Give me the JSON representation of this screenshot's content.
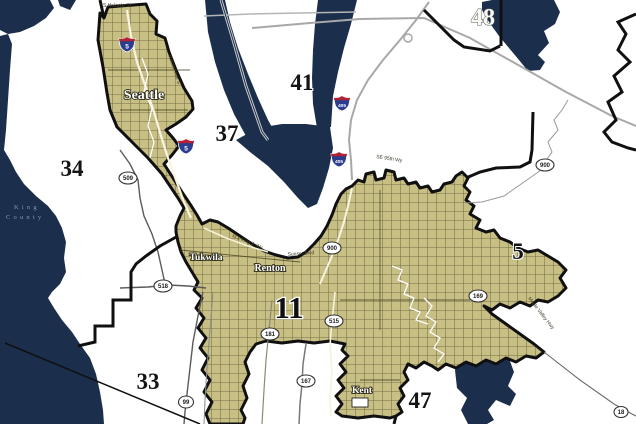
{
  "colors": {
    "water": "#1b2f4d",
    "land": "#ffffff",
    "district_fill": "#c8bf85",
    "district_street": "#57532f",
    "boundary": "#101010",
    "road_gray": "#a8a8a8",
    "interstate_blue": "#2b3d8f",
    "interstate_red": "#b22234",
    "county_text": "#8797ad"
  },
  "county": {
    "name_line1": "King",
    "name_line2": "County"
  },
  "districts": [
    {
      "number": "48"
    },
    {
      "number": "41"
    },
    {
      "number": "37"
    },
    {
      "number": "34"
    },
    {
      "number": "5"
    },
    {
      "number": "33"
    },
    {
      "number": "11"
    },
    {
      "number": "47"
    }
  ],
  "cities": [
    {
      "name": "Seattle"
    },
    {
      "name": "Tukwila"
    },
    {
      "name": "Renton"
    },
    {
      "name": "Kent"
    }
  ],
  "interstates": [
    {
      "route": "5"
    },
    {
      "route": "5"
    },
    {
      "route": "405"
    },
    {
      "route": "405"
    }
  ],
  "state_routes": [
    {
      "route": "509"
    },
    {
      "route": "518"
    },
    {
      "route": "99"
    },
    {
      "route": "900"
    },
    {
      "route": "900"
    },
    {
      "route": "181"
    },
    {
      "route": "515"
    },
    {
      "route": "167"
    },
    {
      "route": "169"
    },
    {
      "route": "18"
    }
  ],
  "streets": [
    {
      "name": "S Holgate St"
    },
    {
      "name": "Rainier Ave S"
    },
    {
      "name": "SE 95th Wy"
    },
    {
      "name": "Sunset Blvd"
    },
    {
      "name": "M L King Jr Wy"
    },
    {
      "name": "Maple Valley Hwy"
    }
  ]
}
